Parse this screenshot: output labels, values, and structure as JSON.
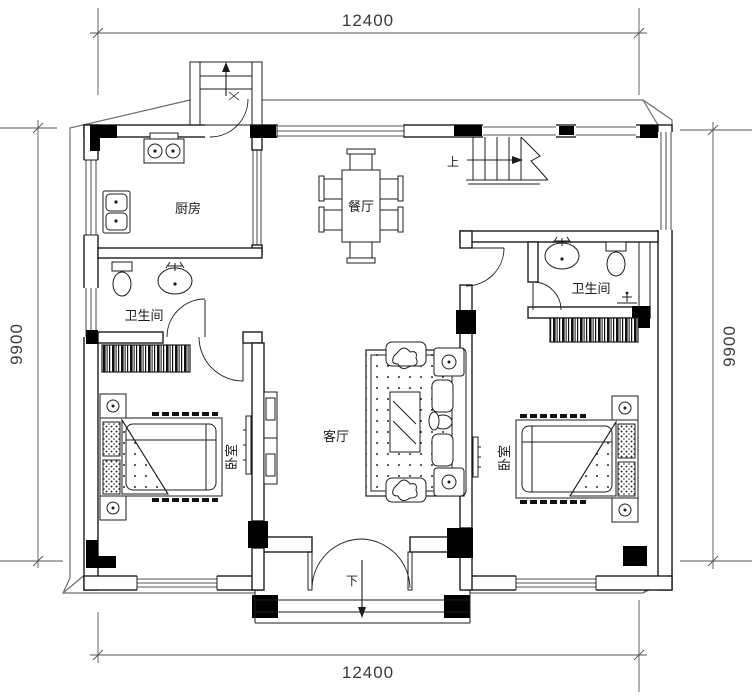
{
  "drawing": {
    "type": "residential-floor-plan",
    "dimensions": {
      "top": "12400",
      "bottom": "12400",
      "left": "9900",
      "right": "9900"
    },
    "rooms": {
      "kitchen": "厨房",
      "dining": "餐厅",
      "bathroom_left": "卫生间",
      "bathroom_right": "卫生间",
      "bedroom_left": "卧室",
      "bedroom_right": "卧室",
      "living": "客厅"
    },
    "stairs": {
      "up_label": "上"
    },
    "entrance": {
      "down_label": "下"
    },
    "colors": {
      "line": "#1c1c1c",
      "column": "#000000",
      "eave": "#6e6e6e",
      "dim_text": "#3a3a3a",
      "background": "#ffffff"
    }
  }
}
